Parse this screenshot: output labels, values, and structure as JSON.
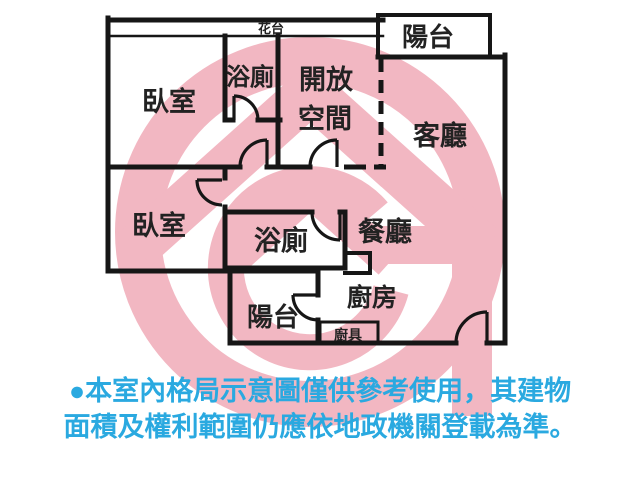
{
  "floorplan": {
    "rooms": {
      "flower_bed": "花台",
      "balcony_top": "陽台",
      "bedroom_top": "臥室",
      "bath_top": "浴廁",
      "open_space_line1": "開放",
      "open_space_line2": "空間",
      "living": "客廳",
      "bedroom_left": "臥室",
      "bath_mid": "浴廁",
      "dining": "餐廳",
      "balcony_bottom": "陽台",
      "kitchen": "廚房",
      "kitchen_counter": "廚具"
    },
    "colors": {
      "wall": "#161616",
      "label": "#222222",
      "watermark_pink": "#f2b7c2",
      "disclaimer_blue": "#2aa9e0",
      "background": "#ffffff"
    },
    "watermark": "house-g-agency-logo"
  },
  "disclaimer": {
    "line1": "●本室內格局示意圖僅供參考使用，其建物",
    "line2": "面積及權利範圍仍應依地政機關登載為準。"
  }
}
